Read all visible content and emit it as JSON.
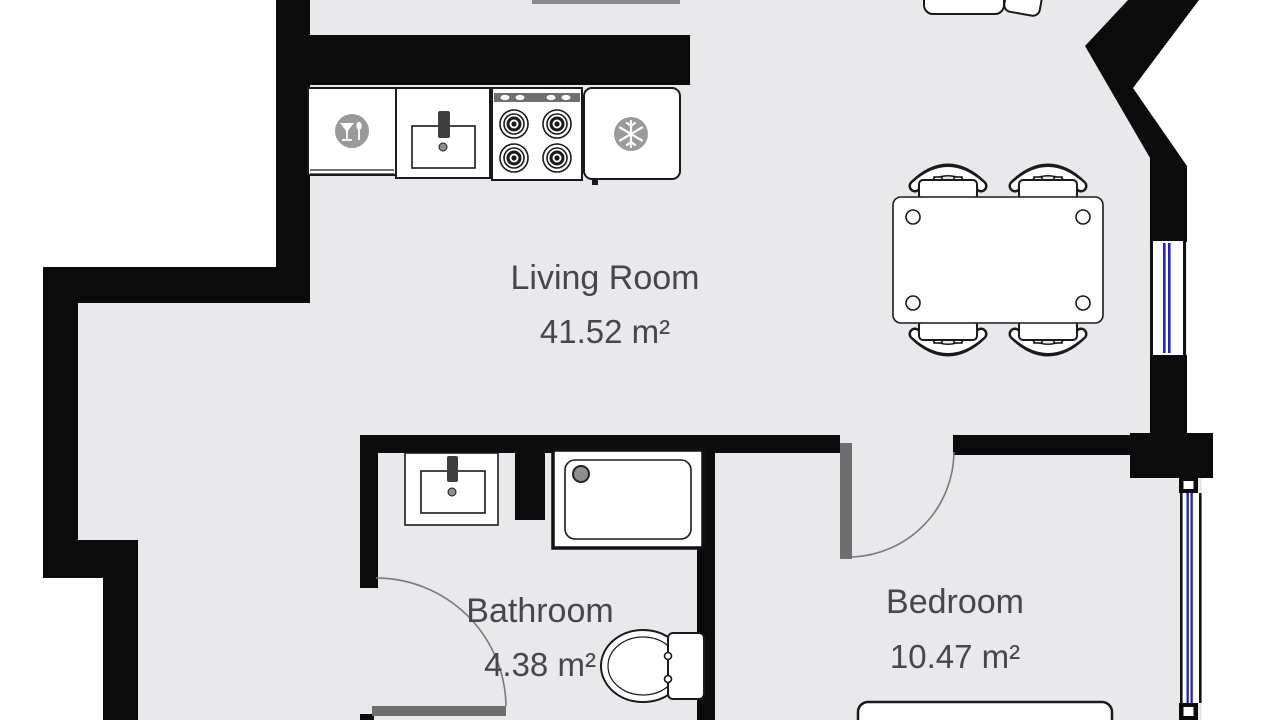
{
  "plan": {
    "title": "Apartment floor plan",
    "rooms": {
      "living": {
        "name": "Living Room",
        "area": "41.52 m²"
      },
      "bathroom": {
        "name": "Bathroom",
        "area": "4.38 m²"
      },
      "bedroom": {
        "name": "Bedroom",
        "area": "10.47 m²"
      }
    },
    "colors": {
      "wall": "#0b0b0b",
      "floor": "#e9e9ec",
      "outside": "#ffffff",
      "window_glass": "#2121cc",
      "door_leaf": "#6e6e6e",
      "appliance_icon": "#9a9a9a",
      "label_text": "#46464d"
    },
    "fixtures": {
      "kitchen": [
        "dishwasher",
        "kitchen-sink",
        "stove",
        "refrigerator"
      ],
      "living": [
        "dining-table",
        "chair",
        "chair",
        "chair",
        "chair",
        "sofa-partial"
      ],
      "bathroom": [
        "bathroom-sink",
        "shower",
        "toilet"
      ],
      "bedroom": [
        "bed"
      ]
    }
  }
}
